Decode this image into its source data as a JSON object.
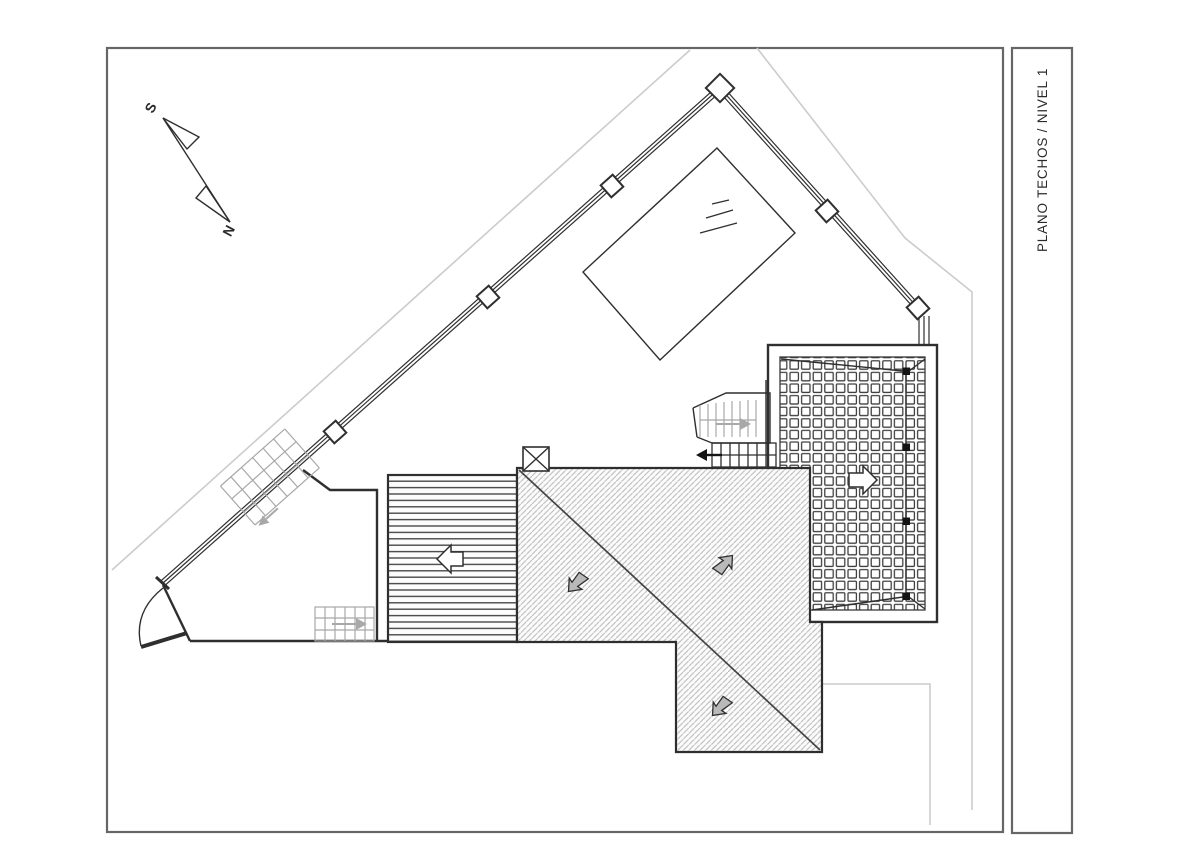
{
  "title_block": {
    "label": "PLANO TECHOS / NIVEL 1"
  },
  "compass": {
    "south": "S",
    "north": "N"
  },
  "colors": {
    "frame_gray": "#666666",
    "line_dark": "#2f2f2f",
    "hatch_gray": "#bdbdbd",
    "deck_line": "#4a4a4a",
    "grid_line": "#3a3a3a",
    "stair_light": "#a8a8a8",
    "arrow_gray": "#b9b9b9",
    "property_gray": "#cccccc",
    "post_black": "#141414",
    "text_dark": "#2b2b2b",
    "paper": "#ffffff"
  }
}
